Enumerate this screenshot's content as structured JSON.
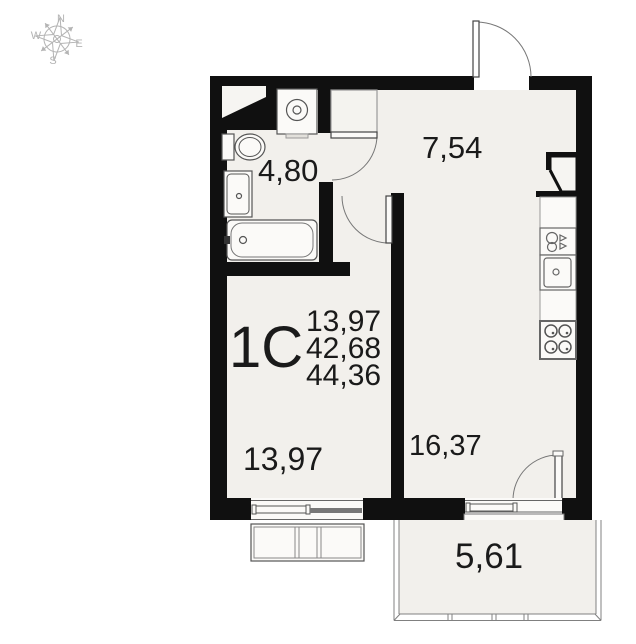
{
  "plan": {
    "compass": {
      "n": "N",
      "w": "W",
      "e": "E",
      "s": "S"
    },
    "unit_label": "1C",
    "unit_areas": {
      "living": "13,97",
      "apartment": "42,68",
      "total": "44,36"
    },
    "rooms": {
      "hallway": "7,54",
      "bathroom": "4,80",
      "living_room": "13,97",
      "kitchen_living": "16,37",
      "balcony": "5,61"
    }
  },
  "colors": {
    "wall": "#101010",
    "floor": "#f2f0ec",
    "fixture_fill": "#fbfaf8",
    "line": "#6b6b6b",
    "text": "#1a1a1a",
    "compass": "#b4b4b4"
  }
}
